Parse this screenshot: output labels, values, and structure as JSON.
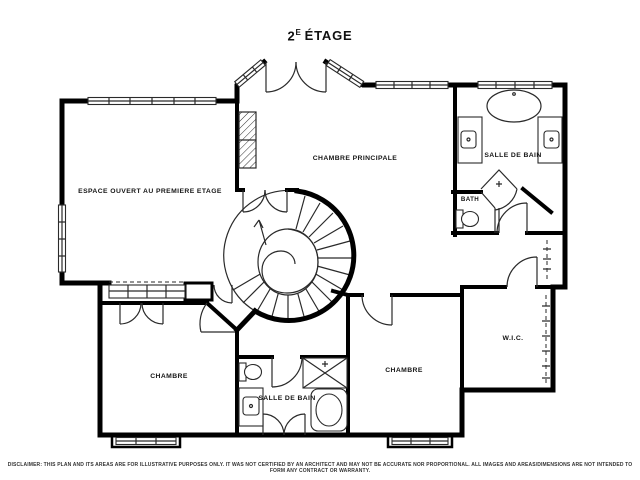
{
  "title": {
    "number": "2",
    "superscript": "E",
    "rest": "ÉTAGE"
  },
  "plan": {
    "rooms": [
      {
        "id": "espace-ouvert",
        "label": "ESPACE OUVERT AU PREMIERE ETAGE"
      },
      {
        "id": "chambre-principale",
        "label": "CHAMBRE PRINCIPALE"
      },
      {
        "id": "salle-de-bain-haut",
        "label": "SALLE DE BAIN"
      },
      {
        "id": "bath",
        "label": "BATH"
      },
      {
        "id": "chambre-gauche",
        "label": "CHAMBRE"
      },
      {
        "id": "salle-de-bain-bas",
        "label": "SALLE DE BAIN"
      },
      {
        "id": "chambre-droite",
        "label": "CHAMBRE"
      },
      {
        "id": "wic",
        "label": "W.I.C."
      }
    ],
    "colors": {
      "walls": "#000000",
      "lines": "#2a2a2a",
      "background": "#ffffff",
      "text": "#111111"
    }
  },
  "disclaimer": "DISCLAIMER: THIS PLAN AND ITS AREAS ARE FOR ILLUSTRATIVE PURPOSES ONLY. IT WAS NOT CERTIFIED BY AN ARCHITECT AND MAY NOT BE ACCURATE NOR PROPORTIONAL. ALL IMAGES AND AREAS/DIMENSIONS ARE NOT INTENDED TO FORM ANY CONTRACT OR WARRANTY."
}
